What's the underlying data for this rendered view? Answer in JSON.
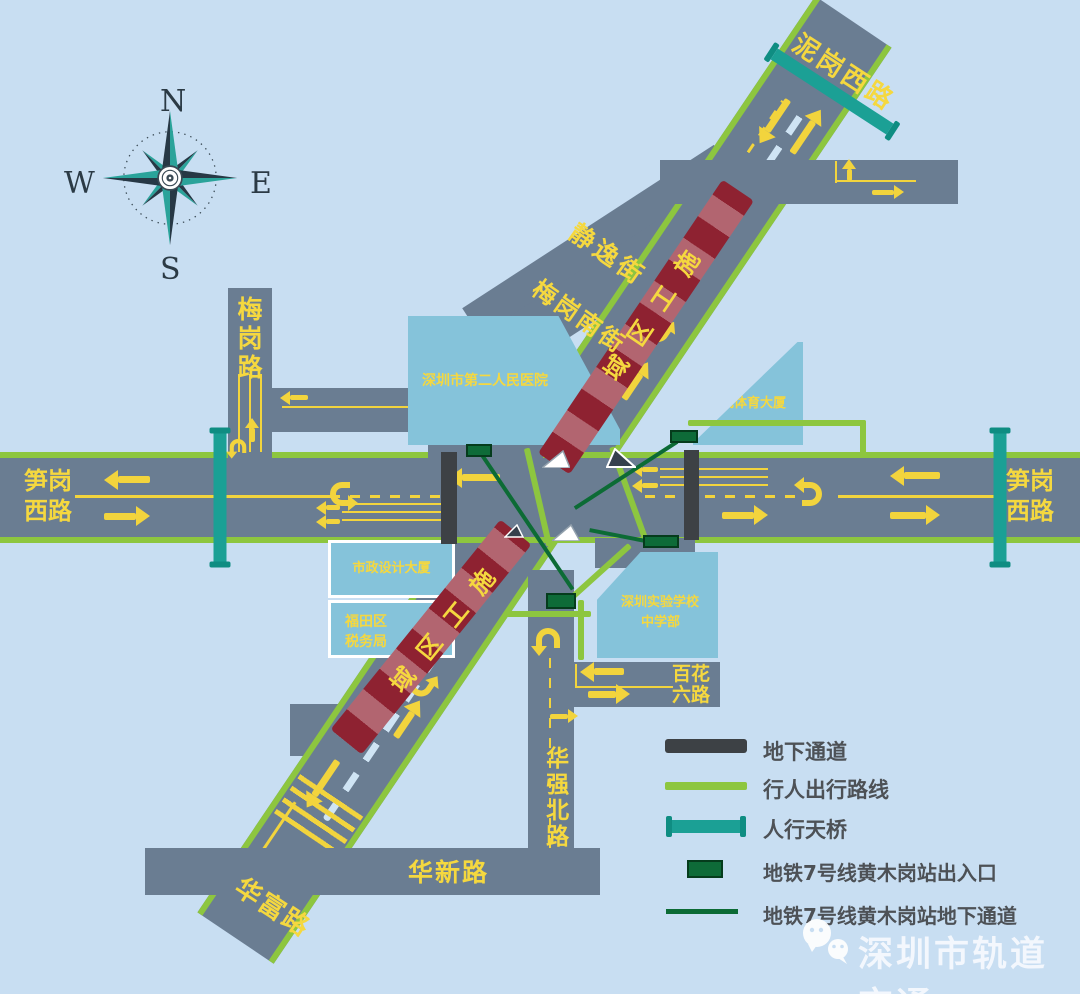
{
  "colors": {
    "background": "#c8def2",
    "road_gray": "#6a7d92",
    "route_green": "#8dc63f",
    "bridge_teal": "#1ba095",
    "construction_red": "#8e2231",
    "metro_green": "#0e6b38",
    "marking_yellow": "#f2d43d",
    "underpass_gray": "#3d4145",
    "building_blue": "#85c3da"
  },
  "compass": {
    "n": "N",
    "w": "W",
    "e": "E",
    "s": "S"
  },
  "roads": {
    "nigang_west": "泥岗西路",
    "sungang_line1": "笋岗",
    "sungang_line2": "西路",
    "meigang": "梅岗路",
    "jingyi": "静逸街",
    "meigang_south": "梅岗南街",
    "huaqiang_north": "华强北路",
    "huaxin": "华新路",
    "huafu": "华富路",
    "baihua_line1": "百花",
    "baihua_line2": "六路"
  },
  "buildings": {
    "hospital": "深圳市第二人民医院",
    "sports": "中成体育大厦",
    "design": "市政设计大厦",
    "tax_line1": "福田区",
    "tax_line2": "税务局",
    "school_line1": "深圳实验学校",
    "school_line2": "中学部"
  },
  "construction": {
    "chars": [
      "施",
      "工",
      "区",
      "域"
    ]
  },
  "legend": {
    "items": [
      {
        "label": "地下通道"
      },
      {
        "label": "行人出行路线"
      },
      {
        "label": "人行天桥"
      },
      {
        "label": "地铁7号线黄木岗站出入口"
      },
      {
        "label": "地铁7号线黄木岗站地下通道"
      }
    ]
  },
  "watermark": {
    "text": "深圳市轨道交通"
  }
}
